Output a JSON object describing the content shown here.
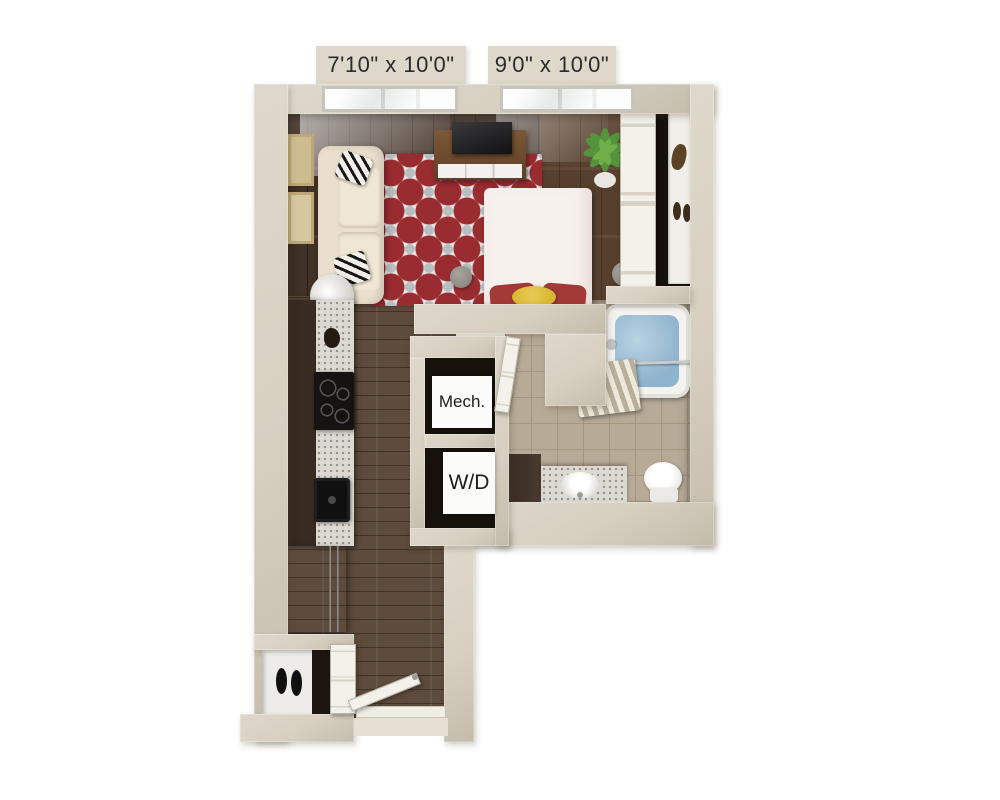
{
  "labels": {
    "living_window_dim": "7'10\" x 10'0\"",
    "bedroom_window_dim": "9'0\" x 10'0\"",
    "mech_closet": "Mech.",
    "washer_dryer": "W/D"
  },
  "colors": {
    "wall": "#d7d0c1",
    "wall_light": "#ded8cb",
    "wall_shade": "#c4bcab",
    "label_text": "#2b2b2b",
    "floor_living": "#46352a",
    "floor_hall": "#5d4b3d",
    "tile": "#b7ab97",
    "tile_line": "#a3977f",
    "rug_base": "#eae8e4",
    "rug_red": "#992c30",
    "rug_accent": "#b6bec1",
    "sofa": "#eadfcc",
    "bed": "#f7f1ed",
    "pillow_red": "#a23a38",
    "pillow_yellow": "#d9b733",
    "wood_furniture": "#6e4c2f",
    "appliance_black": "#151311",
    "cabinet_dark": "#3a2d23",
    "granite": "#dcd9d2",
    "closet_dark": "#17110c",
    "door_white": "#f3f1ea",
    "water": "#8fb4cd",
    "porcelain": "#f4f3f0",
    "plant_green": "#55943c"
  }
}
